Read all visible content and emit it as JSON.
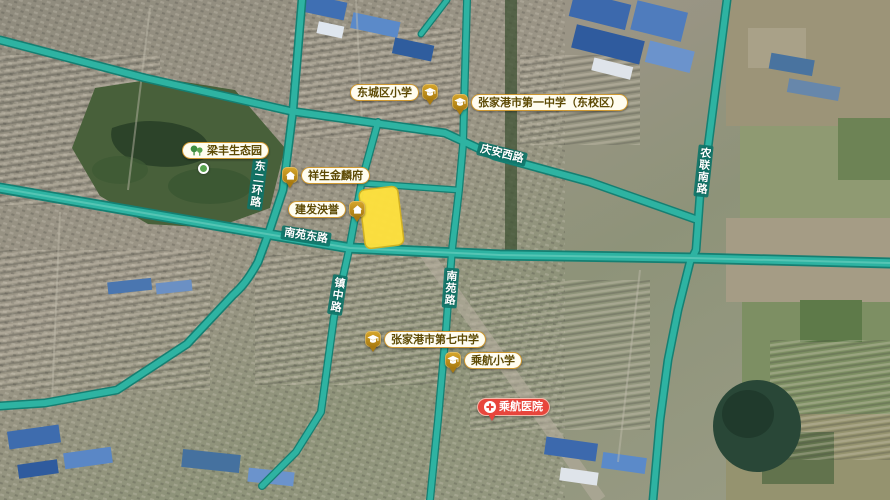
{
  "map": {
    "pois": {
      "dongcheng_primary": {
        "label": "东城区小学",
        "icon": "school"
      },
      "no1_middle": {
        "label": "张家港市第一中学（东校区）",
        "icon": "school"
      },
      "liangfeng_park": {
        "label": "梁丰生态园",
        "icon": "park-trees"
      },
      "xiangsheng_jinlinfu": {
        "label": "祥生金麟府",
        "icon": "residence"
      },
      "jianfa_yangyu": {
        "label": "建发泱誉",
        "icon": "residence"
      },
      "no7_middle": {
        "label": "张家港市第七中学",
        "icon": "school"
      },
      "chenghang_primary": {
        "label": "乘航小学",
        "icon": "school"
      },
      "chenghang_hospital": {
        "label": "乘航医院",
        "icon": "hospital-cross"
      }
    },
    "road_labels": {
      "qingan_west_road": "庆安西路",
      "dong_erhuan_road": "东二环路",
      "nanyuan_east_road": "南苑东路",
      "zhenzhong_road": "镇中路",
      "nanyuan_road": "南苑路",
      "nonglian_south_road": "农联南路"
    },
    "colors": {
      "road_fill": "#2eb3a2",
      "road_casing": "#157f72",
      "parcel_highlight": "#ffe13d",
      "poi_pill_border": "#cf9a33",
      "poi_badge": "#a87a10",
      "hospital_red": "#e8453c",
      "park_green": "#48603a"
    }
  }
}
